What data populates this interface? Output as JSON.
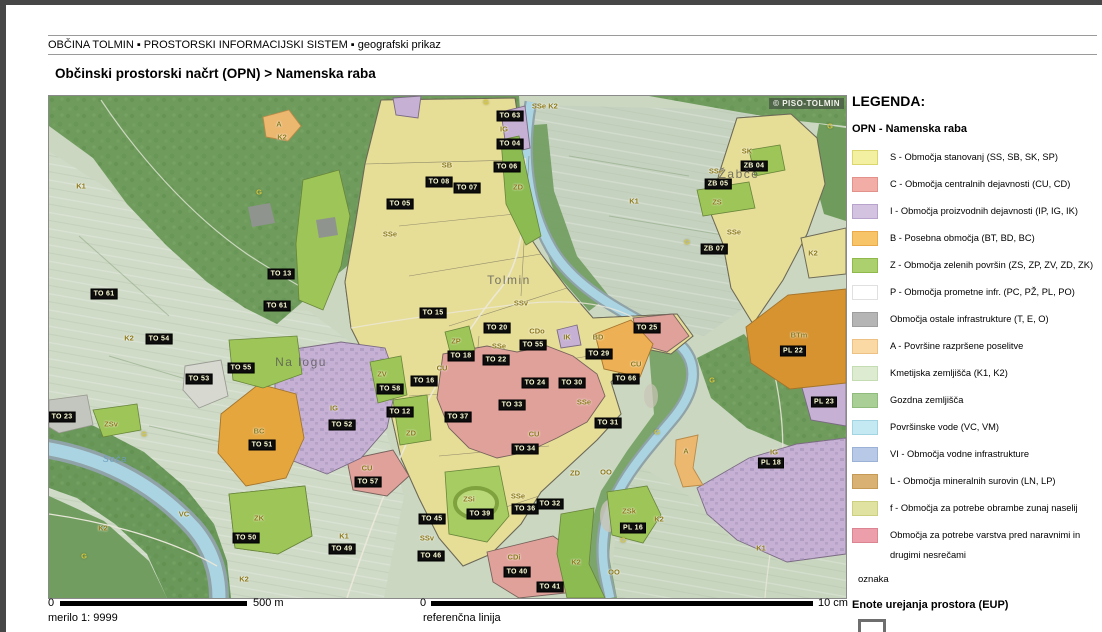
{
  "header": {
    "breadcrumb": "OBČINA TOLMIN ▪ PROSTORSKI INFORMACIJSKI SISTEM ▪ geografski prikaz",
    "title": "Občinski prostorski načrt (OPN) > Namenska raba"
  },
  "map": {
    "watermark": "© PISO-TOLMIN",
    "labels": [
      {
        "t": "TO 05",
        "x": 351,
        "y": 108,
        "k": "e"
      },
      {
        "t": "TO 13",
        "x": 232,
        "y": 178,
        "k": "e"
      },
      {
        "t": "TO 61",
        "x": 55,
        "y": 198,
        "k": "e"
      },
      {
        "t": "TO 61",
        "x": 228,
        "y": 210,
        "k": "e"
      },
      {
        "t": "TO 54",
        "x": 110,
        "y": 243,
        "k": "e"
      },
      {
        "t": "TO 63",
        "x": 461,
        "y": 20,
        "k": "e"
      },
      {
        "t": "TO 04",
        "x": 461,
        "y": 48,
        "k": "e"
      },
      {
        "t": "TO 06",
        "x": 458,
        "y": 71,
        "k": "e"
      },
      {
        "t": "TO 08",
        "x": 390,
        "y": 86,
        "k": "e"
      },
      {
        "t": "TO 07",
        "x": 418,
        "y": 92,
        "k": "e"
      },
      {
        "t": "ZB 04",
        "x": 705,
        "y": 70,
        "k": "e"
      },
      {
        "t": "ZB 05",
        "x": 669,
        "y": 88,
        "k": "e"
      },
      {
        "t": "ZB 07",
        "x": 665,
        "y": 153,
        "k": "e"
      },
      {
        "t": "TO 25",
        "x": 598,
        "y": 232,
        "k": "e"
      },
      {
        "t": "TO 15",
        "x": 384,
        "y": 217,
        "k": "e"
      },
      {
        "t": "TO 20",
        "x": 448,
        "y": 232,
        "k": "e"
      },
      {
        "t": "TO 18",
        "x": 412,
        "y": 260,
        "k": "e"
      },
      {
        "t": "TO 22",
        "x": 447,
        "y": 264,
        "k": "e"
      },
      {
        "t": "TO 16",
        "x": 375,
        "y": 285,
        "k": "e"
      },
      {
        "t": "TO 55",
        "x": 484,
        "y": 249,
        "k": "e"
      },
      {
        "t": "TO 24",
        "x": 486,
        "y": 287,
        "k": "e"
      },
      {
        "t": "TO 30",
        "x": 523,
        "y": 287,
        "k": "e"
      },
      {
        "t": "TO 29",
        "x": 550,
        "y": 258,
        "k": "e"
      },
      {
        "t": "TO 66",
        "x": 577,
        "y": 283,
        "k": "e"
      },
      {
        "t": "TO 31",
        "x": 559,
        "y": 327,
        "k": "e"
      },
      {
        "t": "TO 33",
        "x": 463,
        "y": 309,
        "k": "e"
      },
      {
        "t": "TO 37",
        "x": 409,
        "y": 321,
        "k": "e"
      },
      {
        "t": "TO 34",
        "x": 476,
        "y": 353,
        "k": "e"
      },
      {
        "t": "TO 52",
        "x": 293,
        "y": 329,
        "k": "e"
      },
      {
        "t": "TO 58",
        "x": 341,
        "y": 293,
        "k": "e"
      },
      {
        "t": "TO 12",
        "x": 351,
        "y": 316,
        "k": "e"
      },
      {
        "t": "TO 57",
        "x": 319,
        "y": 386,
        "k": "e"
      },
      {
        "t": "TO 51",
        "x": 213,
        "y": 349,
        "k": "e"
      },
      {
        "t": "TO 53",
        "x": 150,
        "y": 283,
        "k": "e"
      },
      {
        "t": "TO 55",
        "x": 192,
        "y": 272,
        "k": "e"
      },
      {
        "t": "TO 23",
        "x": 13,
        "y": 321,
        "k": "e"
      },
      {
        "t": "TO 39",
        "x": 431,
        "y": 418,
        "k": "e"
      },
      {
        "t": "TO 36",
        "x": 476,
        "y": 413,
        "k": "e"
      },
      {
        "t": "TO 32",
        "x": 501,
        "y": 408,
        "k": "e"
      },
      {
        "t": "TO 40",
        "x": 468,
        "y": 476,
        "k": "e"
      },
      {
        "t": "TO 41",
        "x": 501,
        "y": 491,
        "k": "e"
      },
      {
        "t": "TO 50",
        "x": 197,
        "y": 442,
        "k": "e"
      },
      {
        "t": "TO 49",
        "x": 293,
        "y": 453,
        "k": "e"
      },
      {
        "t": "TO 45",
        "x": 383,
        "y": 423,
        "k": "e"
      },
      {
        "t": "TO 46",
        "x": 382,
        "y": 460,
        "k": "e"
      },
      {
        "t": "PL 16",
        "x": 584,
        "y": 432,
        "k": "e"
      },
      {
        "t": "PL 18",
        "x": 722,
        "y": 367,
        "k": "e"
      },
      {
        "t": "PL 22",
        "x": 744,
        "y": 255,
        "k": "e"
      },
      {
        "t": "PL 23",
        "x": 775,
        "y": 306,
        "k": "e"
      },
      {
        "t": "K1",
        "x": 32,
        "y": 90,
        "k": "z"
      },
      {
        "t": "A",
        "x": 230,
        "y": 28,
        "k": "z"
      },
      {
        "t": "K2",
        "x": 233,
        "y": 41,
        "k": "z"
      },
      {
        "t": "G",
        "x": 210,
        "y": 96,
        "k": "zb"
      },
      {
        "t": "G",
        "x": 437,
        "y": 6,
        "k": "zb"
      },
      {
        "t": "SSe",
        "x": 341,
        "y": 138,
        "k": "z"
      },
      {
        "t": "SB",
        "x": 398,
        "y": 69,
        "k": "z"
      },
      {
        "t": "SSe",
        "x": 490,
        "y": 10,
        "k": "z"
      },
      {
        "t": "K2",
        "x": 504,
        "y": 10,
        "k": "z"
      },
      {
        "t": "SK",
        "x": 698,
        "y": 55,
        "k": "z"
      },
      {
        "t": "SSe",
        "x": 667,
        "y": 75,
        "k": "z"
      },
      {
        "t": "ZS",
        "x": 668,
        "y": 106,
        "k": "z"
      },
      {
        "t": "SSe",
        "x": 685,
        "y": 136,
        "k": "z"
      },
      {
        "t": "K2",
        "x": 764,
        "y": 157,
        "k": "z"
      },
      {
        "t": "K1",
        "x": 585,
        "y": 105,
        "k": "z"
      },
      {
        "t": "G",
        "x": 781,
        "y": 30,
        "k": "zb"
      },
      {
        "t": "G",
        "x": 638,
        "y": 146,
        "k": "zb"
      },
      {
        "t": "ZD",
        "x": 469,
        "y": 91,
        "k": "z"
      },
      {
        "t": "IG",
        "x": 455,
        "y": 33,
        "k": "z"
      },
      {
        "t": "K2",
        "x": 80,
        "y": 242,
        "k": "z"
      },
      {
        "t": "ZP",
        "x": 407,
        "y": 245,
        "k": "z"
      },
      {
        "t": "SSv",
        "x": 472,
        "y": 207,
        "k": "z"
      },
      {
        "t": "CU",
        "x": 393,
        "y": 272,
        "k": "z"
      },
      {
        "t": "CDo",
        "x": 488,
        "y": 235,
        "k": "z"
      },
      {
        "t": "SSe",
        "x": 450,
        "y": 250,
        "k": "z"
      },
      {
        "t": "CU",
        "x": 587,
        "y": 268,
        "k": "z"
      },
      {
        "t": "BD",
        "x": 549,
        "y": 241,
        "k": "z"
      },
      {
        "t": "CU",
        "x": 485,
        "y": 338,
        "k": "z"
      },
      {
        "t": "SSe",
        "x": 535,
        "y": 306,
        "k": "z"
      },
      {
        "t": "IK",
        "x": 518,
        "y": 241,
        "k": "z"
      },
      {
        "t": "IG",
        "x": 285,
        "y": 312,
        "k": "z"
      },
      {
        "t": "BC",
        "x": 210,
        "y": 335,
        "k": "z"
      },
      {
        "t": "ZV",
        "x": 333,
        "y": 278,
        "k": "z"
      },
      {
        "t": "ZD",
        "x": 362,
        "y": 337,
        "k": "z"
      },
      {
        "t": "SSe",
        "x": 469,
        "y": 400,
        "k": "z"
      },
      {
        "t": "ZSi",
        "x": 420,
        "y": 403,
        "k": "z"
      },
      {
        "t": "ZK",
        "x": 210,
        "y": 422,
        "k": "z"
      },
      {
        "t": "K1",
        "x": 295,
        "y": 440,
        "k": "z"
      },
      {
        "t": "SSv",
        "x": 378,
        "y": 442,
        "k": "z"
      },
      {
        "t": "ZD",
        "x": 526,
        "y": 377,
        "k": "z"
      },
      {
        "t": "CDi",
        "x": 465,
        "y": 461,
        "k": "z"
      },
      {
        "t": "ZSk",
        "x": 580,
        "y": 415,
        "k": "z"
      },
      {
        "t": "K2",
        "x": 610,
        "y": 423,
        "k": "z"
      },
      {
        "t": "K2",
        "x": 527,
        "y": 466,
        "k": "z"
      },
      {
        "t": "A",
        "x": 637,
        "y": 355,
        "k": "z"
      },
      {
        "t": "IG",
        "x": 725,
        "y": 356,
        "k": "z"
      },
      {
        "t": "BTm",
        "x": 750,
        "y": 239,
        "k": "z"
      },
      {
        "t": "K1",
        "x": 712,
        "y": 452,
        "k": "z"
      },
      {
        "t": "ZSv",
        "x": 62,
        "y": 328,
        "k": "z"
      },
      {
        "t": "G",
        "x": 95,
        "y": 338,
        "k": "zb"
      },
      {
        "t": "VC",
        "x": 135,
        "y": 418,
        "k": "z"
      },
      {
        "t": "G",
        "x": 35,
        "y": 460,
        "k": "zb"
      },
      {
        "t": "K2",
        "x": 54,
        "y": 432,
        "k": "z"
      },
      {
        "t": "K2",
        "x": 195,
        "y": 483,
        "k": "z"
      },
      {
        "t": "G",
        "x": 663,
        "y": 284,
        "k": "zb"
      },
      {
        "t": "G",
        "x": 608,
        "y": 336,
        "k": "zb"
      },
      {
        "t": "OO",
        "x": 557,
        "y": 376,
        "k": "z"
      },
      {
        "t": "OO",
        "x": 565,
        "y": 476,
        "k": "z"
      },
      {
        "t": "G",
        "x": 574,
        "y": 444,
        "k": "zb"
      },
      {
        "t": "CU",
        "x": 318,
        "y": 372,
        "k": "z"
      },
      {
        "t": "Tolmin",
        "x": 460,
        "y": 184,
        "k": "p"
      },
      {
        "t": "Žabče",
        "x": 690,
        "y": 78,
        "k": "p"
      },
      {
        "t": "Na logu",
        "x": 252,
        "y": 266,
        "k": "p"
      },
      {
        "t": "Soča",
        "x": 66,
        "y": 363,
        "k": "w"
      }
    ]
  },
  "legend": {
    "title": "LEGENDA:",
    "section": "OPN - Namenska raba",
    "items": [
      {
        "color": "#f3f1a1",
        "border": "#dcd66e",
        "label": "S - Območja stanovanj (SS, SB, SK, SP)"
      },
      {
        "color": "#f2ada6",
        "border": "#e2928a",
        "label": "C - Območja centralnih dejavnosti (CU, CD)"
      },
      {
        "color": "#d3c3e0",
        "border": "#b7a3cb",
        "label": "I - Območja proizvodnih dejavnosti (IP, IG, IK)"
      },
      {
        "color": "#f7c468",
        "border": "#eaa94b",
        "label": "B - Posebna območja (BT, BD, BC)"
      },
      {
        "color": "#abd06d",
        "border": "#8fba4b",
        "label": "Z - Območja zelenih površin (ZS, ZP, ZV, ZD, ZK)"
      },
      {
        "color": "#ffffff",
        "border": "#e0e0e0",
        "label": "P - Območja prometne infr. (PC, PŽ, PL, PO)"
      },
      {
        "color": "#b5b5b5",
        "border": "#9e9e9e",
        "label": "Območja ostale infrastrukture (T, E, O)"
      },
      {
        "color": "#fad9a4",
        "border": "#edc183",
        "label": "A - Površine razpršene poselitve"
      },
      {
        "color": "#ddecd0",
        "border": "#c4dcb2",
        "label": "Kmetijska zemljišča (K1, K2)"
      },
      {
        "color": "#a9cf97",
        "border": "#8fbc7d",
        "label": "Gozdna zemljišča"
      },
      {
        "color": "#c5e9f2",
        "border": "#a3d4e2",
        "label": "Površinske vode (VC, VM)"
      },
      {
        "color": "#b7c9e6",
        "border": "#9bb2d6",
        "label": "VI - Območja vodne infrastrukture"
      },
      {
        "color": "#d9b273",
        "border": "#c59a55",
        "label": "L - Območja mineralnih surovin (LN, LP)"
      },
      {
        "color": "#e0e2a2",
        "border": "#cccf7f",
        "label": "f - Območja za potrebe obrambe zunaj naselij"
      },
      {
        "color": "#ec9fab",
        "border": "#dd8492",
        "label": "Območja za potrebe varstva pred naravnimi in drugimi nesrečami"
      }
    ],
    "oznaka_label": "oznaka",
    "eup_title": "Enote urejanja prostora (EUP)",
    "eup_sample": "PO_5",
    "eup_oznaka": "oznaka"
  },
  "scale": {
    "left_zero": "0",
    "left_label": "500 m",
    "merilo": "merilo 1: 9999",
    "right_zero": "0",
    "right_label": "10 cm",
    "reference": "referenčna linija"
  }
}
